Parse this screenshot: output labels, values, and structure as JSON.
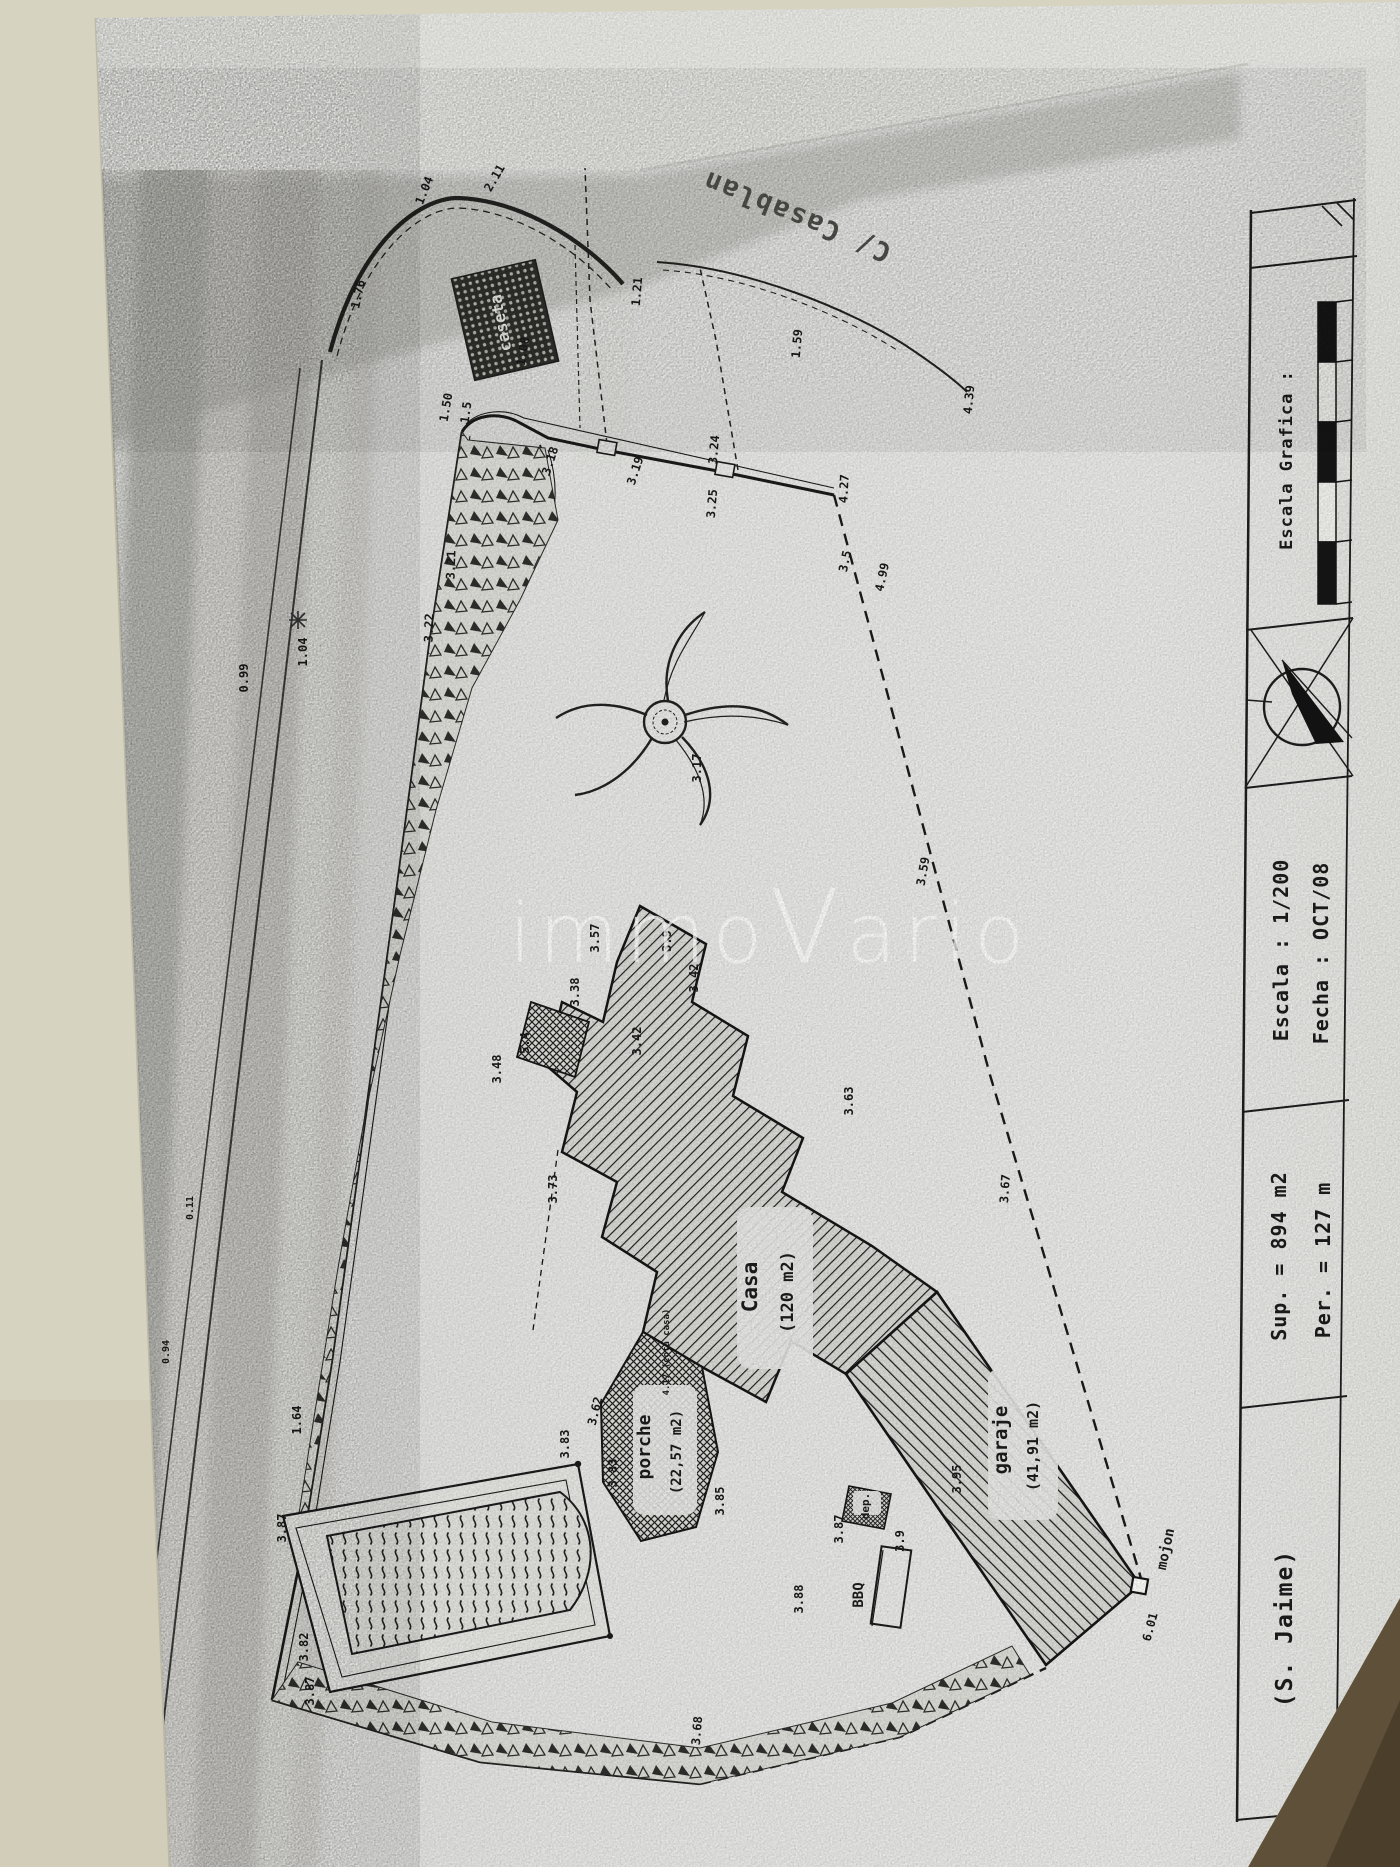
{
  "watermark": {
    "p1": "immo",
    "p2": "V",
    "p3": "ario"
  },
  "streets": {
    "left": "Tunez",
    "top": "C/ Casablan"
  },
  "labels": {
    "casa_name": "Casa",
    "casa_area": "(120 m2)",
    "garaje_name": "garaje",
    "garaje_area": "(41,91 m2)",
    "porche_name": "porche",
    "porche_area": "(22,57 m2)",
    "caseta": "caseta",
    "dep": "dep.",
    "bbq": "BBQ",
    "mojon": "mojon",
    "cota_casa": "4.17 (cota casa)"
  },
  "titleblock": {
    "escala_grafica": "Escala Grafica :",
    "escala": "Escala : 1/200",
    "fecha": "Fecha : OCT/08",
    "sup": "Sup. = 894 m2",
    "per": "Per. = 127 m",
    "author": "(S. Jaime)"
  },
  "dims": [
    "1.50",
    "1.76",
    "1.04",
    "2.11",
    "1.08",
    "1.5",
    "1.21",
    "1.59",
    "4.39",
    "3.18",
    "3.19",
    "3.24",
    "3.25",
    "4.27",
    "3.5",
    "4.99",
    "3.21",
    "3.22",
    "0.99",
    "1.04",
    "0.11",
    "0.94",
    "3.17",
    "3.57",
    "3.9",
    "3.38",
    "3.42",
    "3.42",
    "5.4",
    "3.48",
    "3.73",
    "3.59",
    "3.63",
    "3.67",
    "3.95",
    "3.87",
    "3.9",
    "3.88",
    "6.01",
    "1.64",
    "3.83",
    "3.62",
    "3.87",
    "3.82",
    "3.87",
    "3.83",
    "3.85",
    "3.68"
  ]
}
